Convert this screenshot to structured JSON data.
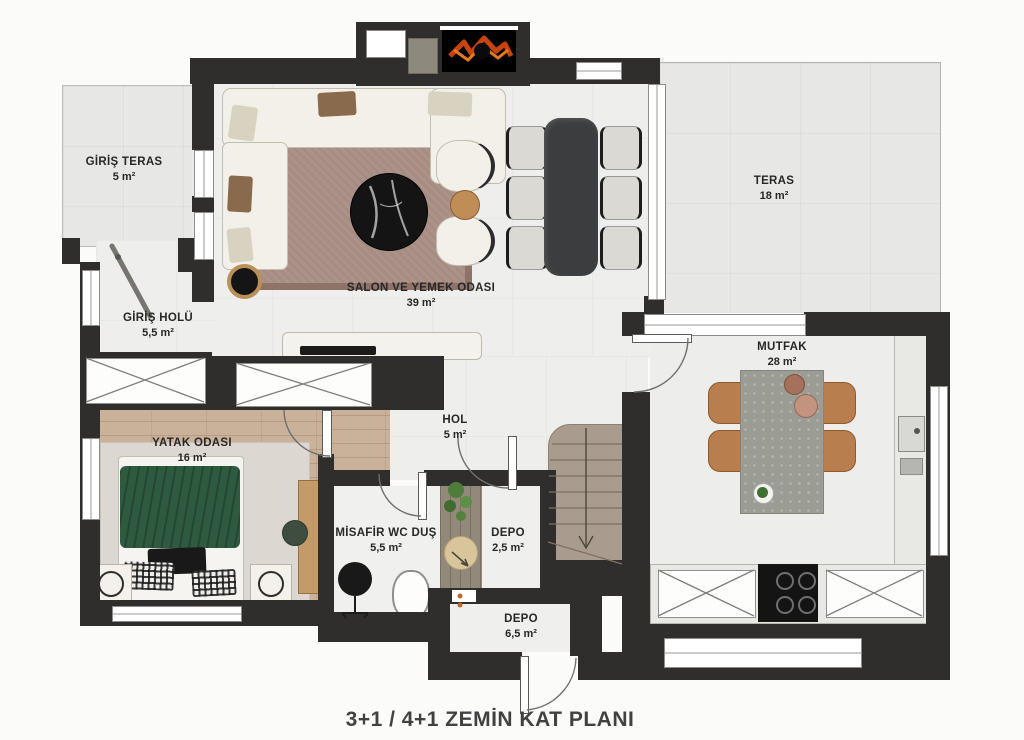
{
  "title": "3+1 / 4+1 ZEMİN KAT PLANI",
  "rooms": {
    "giris_teras": {
      "name": "GİRİŞ TERAS",
      "area": "5 m²"
    },
    "giris_holu": {
      "name": "GİRİŞ HOLÜ",
      "area": "5,5 m²"
    },
    "salon": {
      "name": "SALON VE YEMEK ODASI",
      "area": "39 m²"
    },
    "teras": {
      "name": "TERAS",
      "area": "18 m²"
    },
    "mutfak": {
      "name": "MUTFAK",
      "area": "28 m²"
    },
    "hol": {
      "name": "HOL",
      "area": "5 m²"
    },
    "yatak_odasi": {
      "name": "YATAK ODASI",
      "area": "16 m²"
    },
    "misafir_wc": {
      "name": "MİSAFİR WC DUŞ",
      "area": "5,5 m²"
    },
    "depo_small": {
      "name": "DEPO",
      "area": "2,5 m²"
    },
    "depo_large": {
      "name": "DEPO",
      "area": "6,5 m²"
    }
  },
  "colors": {
    "wall": "#2f2e2c",
    "wood_floor": "#c9b299",
    "bed_green": "#2e5a40",
    "rug": "#a78c82",
    "stair_wood": "#a99b8d"
  }
}
